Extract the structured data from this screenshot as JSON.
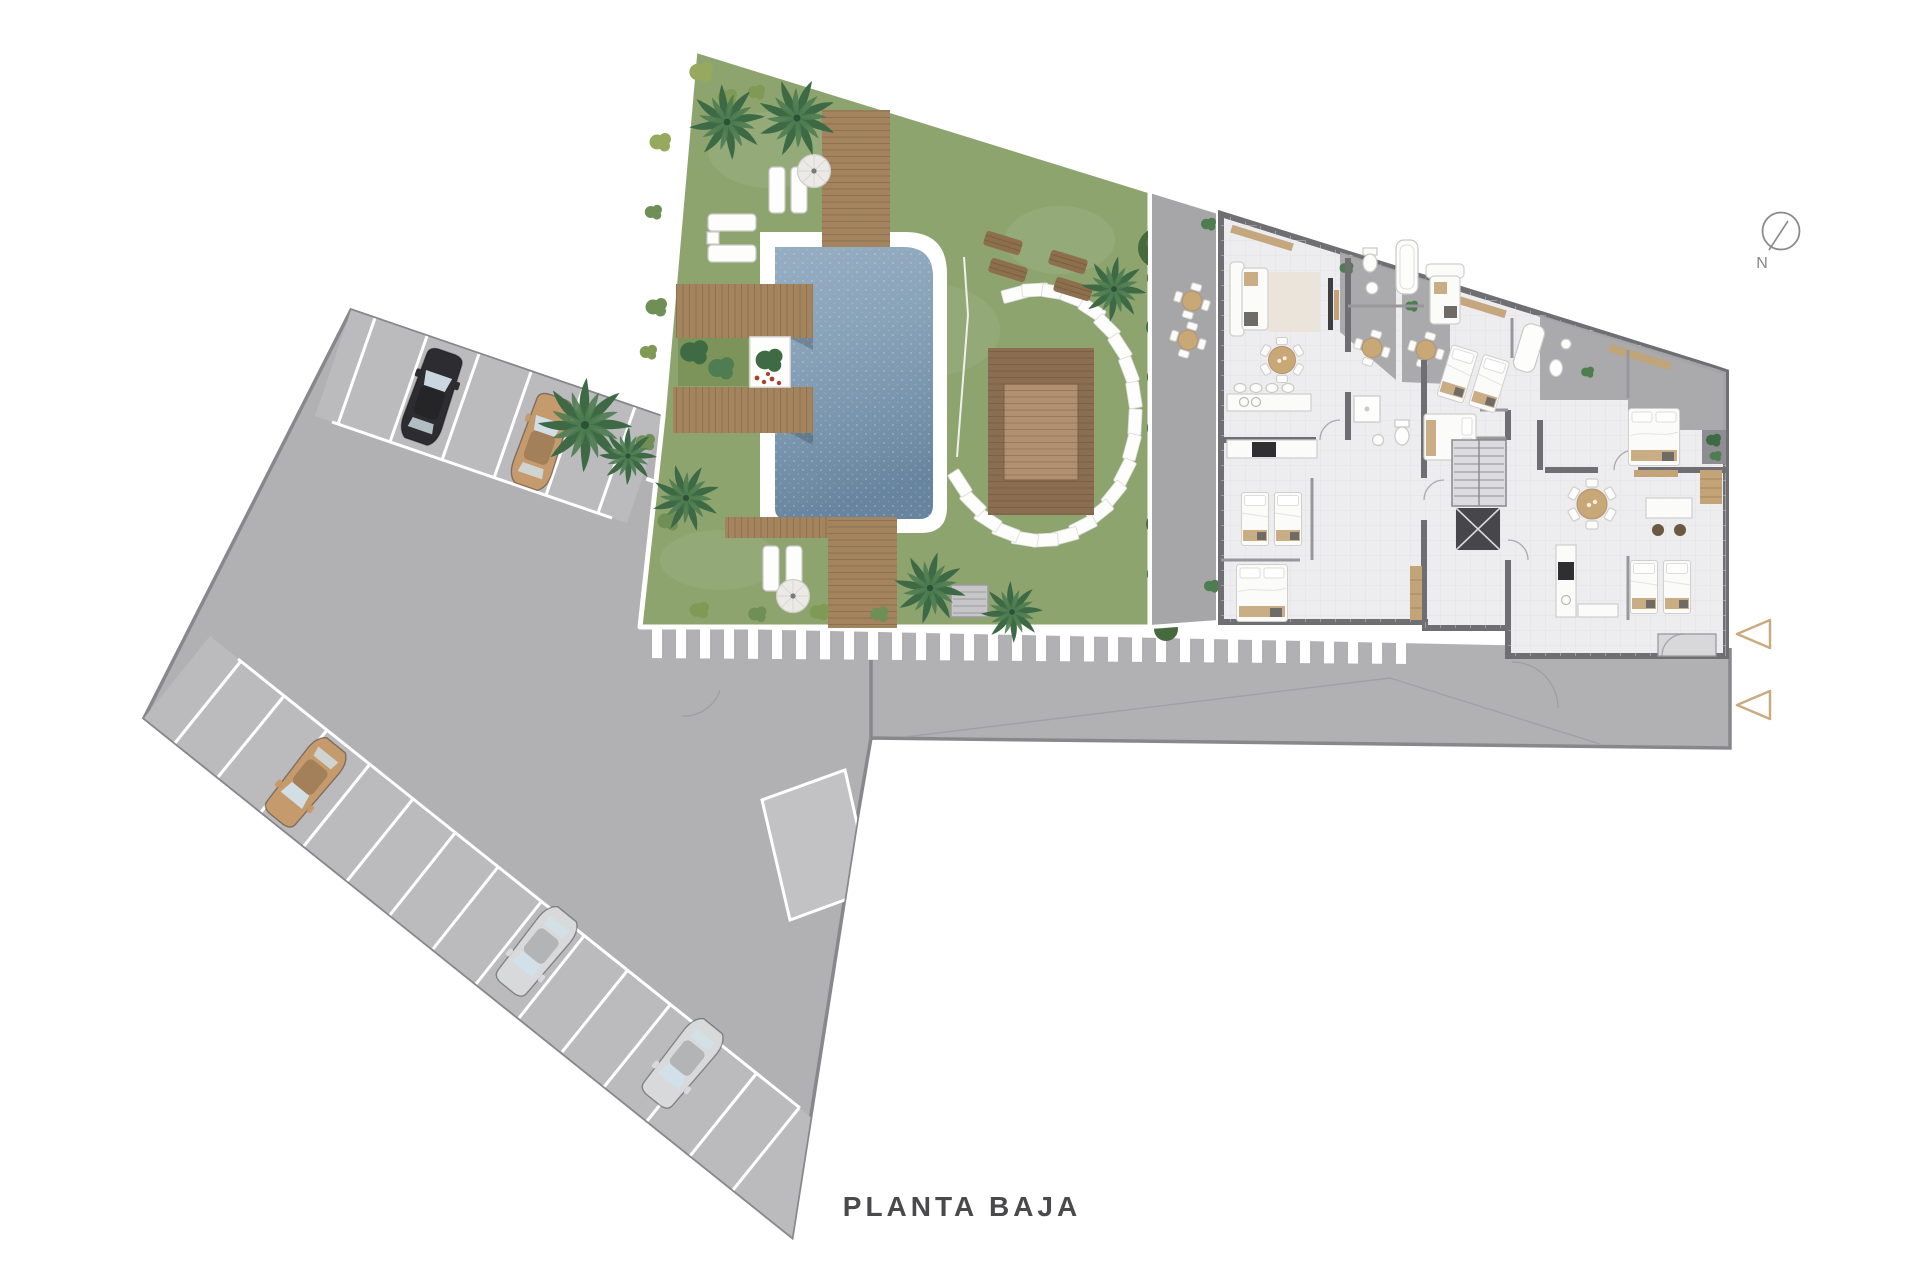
{
  "title": {
    "label": "PLANTA BAJA"
  },
  "compass": {
    "label": "N"
  },
  "colors": {
    "background": "#ffffff",
    "pavement": "#b1b0b3",
    "stall_band": "#bbbabd",
    "ramp": "#c2c1c4",
    "grass": "#8da46f",
    "pool_water": "#7e9cb5",
    "wood": "#a3845f",
    "pergola": "#8b6e51",
    "pergola_inner": "#b09070",
    "floor": "#edecef",
    "wall": "#6f6e73",
    "terrace": "#a6a5a8",
    "hedge": "#4a6f41",
    "palm": "#3d6a45",
    "stripe": "#ffffff",
    "arrow": "#c9ab7f",
    "title_text": "#4a4a4c",
    "compass_stroke": "#8a8a8d"
  },
  "parking": {
    "top_row_stalls": 6,
    "side_row_stalls": 13,
    "cars": [
      {
        "name": "car-black",
        "hex": "#2d2d31"
      },
      {
        "name": "car-tan",
        "hex": "#c59a6d"
      },
      {
        "name": "car-tan-2",
        "hex": "#c59a6d"
      },
      {
        "name": "car-silver",
        "hex": "#d8d9db"
      },
      {
        "name": "car-silver-2",
        "hex": "#d8d9db"
      }
    ]
  },
  "icons": [
    "north-compass-icon",
    "entrance-arrow-icon",
    "palm-tree-icon",
    "bush-icon",
    "car-icon",
    "swimming-pool",
    "sun-lounger-icon",
    "round-daybed-icon",
    "stepping-stones",
    "pergola-deck",
    "bed-icon",
    "sofa-icon",
    "dining-table-icon",
    "kitchen-icon",
    "bathroom-icon",
    "stairs-icon",
    "elevator-icon",
    "crosswalk-stripes"
  ]
}
